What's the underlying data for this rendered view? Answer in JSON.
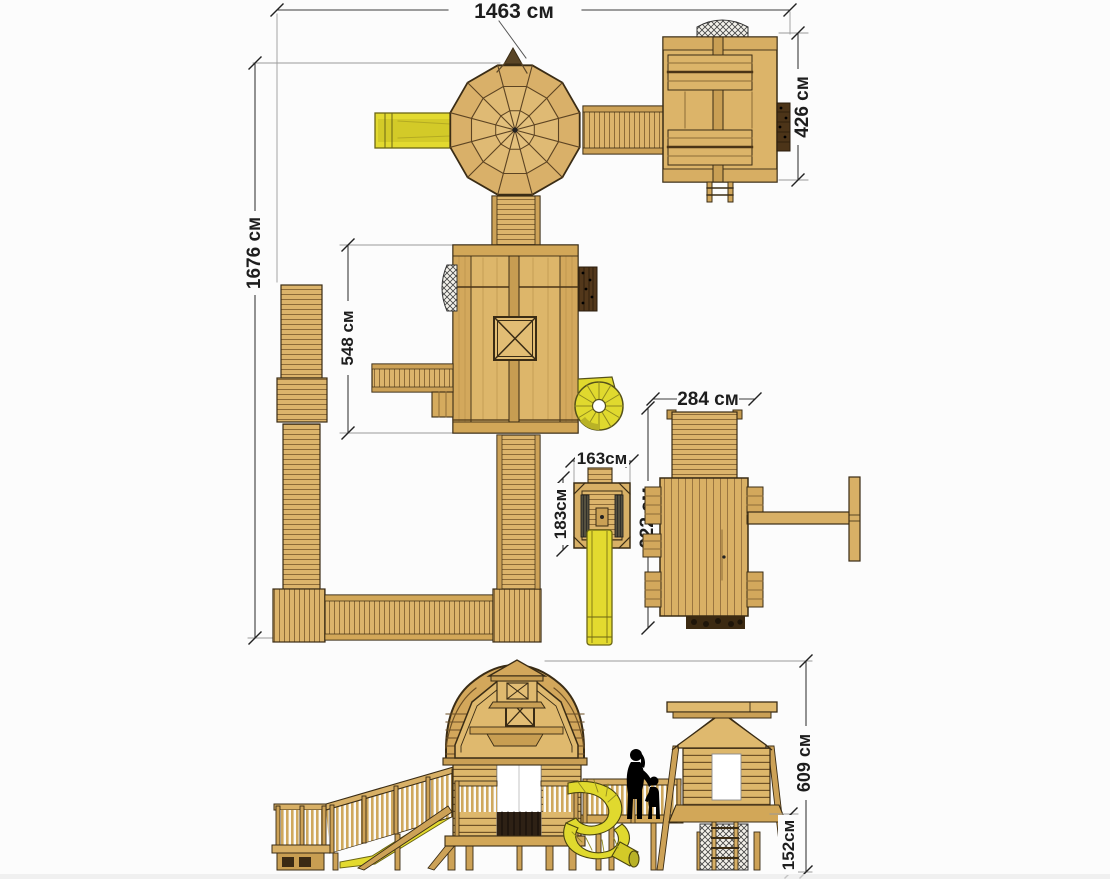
{
  "dimensions": {
    "plan": {
      "overall_width": "1463 см",
      "overall_depth": "1676 см",
      "top_tower_depth": "426 см",
      "main_house_depth": "548 см",
      "side_unit_width": "284 см",
      "side_unit_depth": "622 см",
      "small_tower_width": "163см",
      "small_tower_depth": "183см"
    },
    "elevation": {
      "total_height": "609 см",
      "deck_height": "152см"
    }
  },
  "colors": {
    "background": "#fcfcfc",
    "wood": "#dcb469",
    "wood_dark": "#c99f54",
    "wood_light": "#e5c181",
    "outline": "#3a2c15",
    "slide_yellow": "#e3da2f",
    "climb_wall_brown": "#4c3418",
    "dimension_line": "#3c3c3c",
    "silhouette": "#000000",
    "slide_red": "#b04745"
  }
}
